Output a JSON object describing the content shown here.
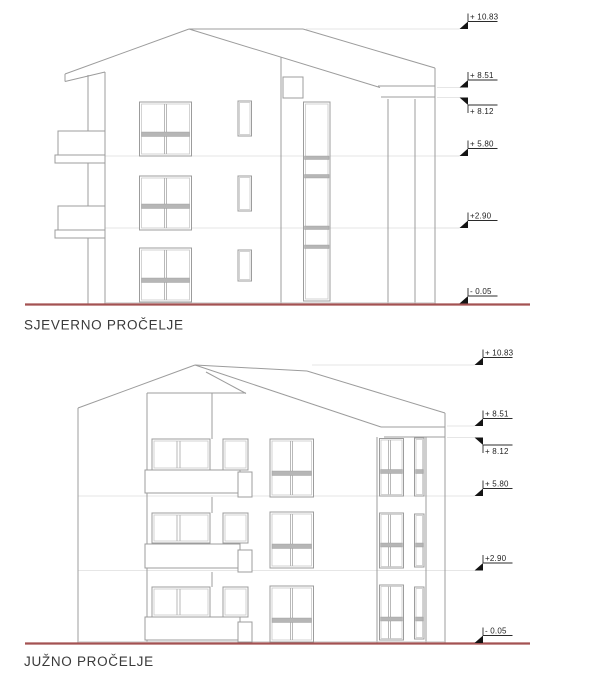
{
  "north": {
    "title": "SJEVERNO PROČELJE",
    "markers": [
      {
        "label": "+ 10.83",
        "value": 10.83,
        "flipped": false
      },
      {
        "label": "+ 8.51",
        "value": 8.51,
        "flipped": false
      },
      {
        "label": "+ 8.12",
        "value": 8.12,
        "flipped": true
      },
      {
        "label": "+ 5.80",
        "value": 5.8,
        "flipped": false
      },
      {
        "label": "+2.90",
        "value": 2.9,
        "flipped": false
      },
      {
        "label": "- 0.05",
        "value": -0.05,
        "flipped": false
      }
    ]
  },
  "south": {
    "title": "JUŽNO PROČELJE",
    "markers": [
      {
        "label": "+ 10.83",
        "value": 10.83,
        "flipped": false
      },
      {
        "label": "+ 8.51",
        "value": 8.51,
        "flipped": false
      },
      {
        "label": "+ 8.12",
        "value": 8.12,
        "flipped": true
      },
      {
        "label": "+ 5.80",
        "value": 5.8,
        "flipped": false
      },
      {
        "label": "+2.90",
        "value": 2.9,
        "flipped": false
      },
      {
        "label": "- 0.05",
        "value": -0.05,
        "flipped": false
      }
    ]
  },
  "colors": {
    "drawing_line": "#9c9c9c",
    "faint_line": "#dedede",
    "window_band": "#b6b6b6",
    "ground_line": "#a35252",
    "marker": "#141414",
    "title_text": "#3a3a3a",
    "background": "#ffffff"
  }
}
